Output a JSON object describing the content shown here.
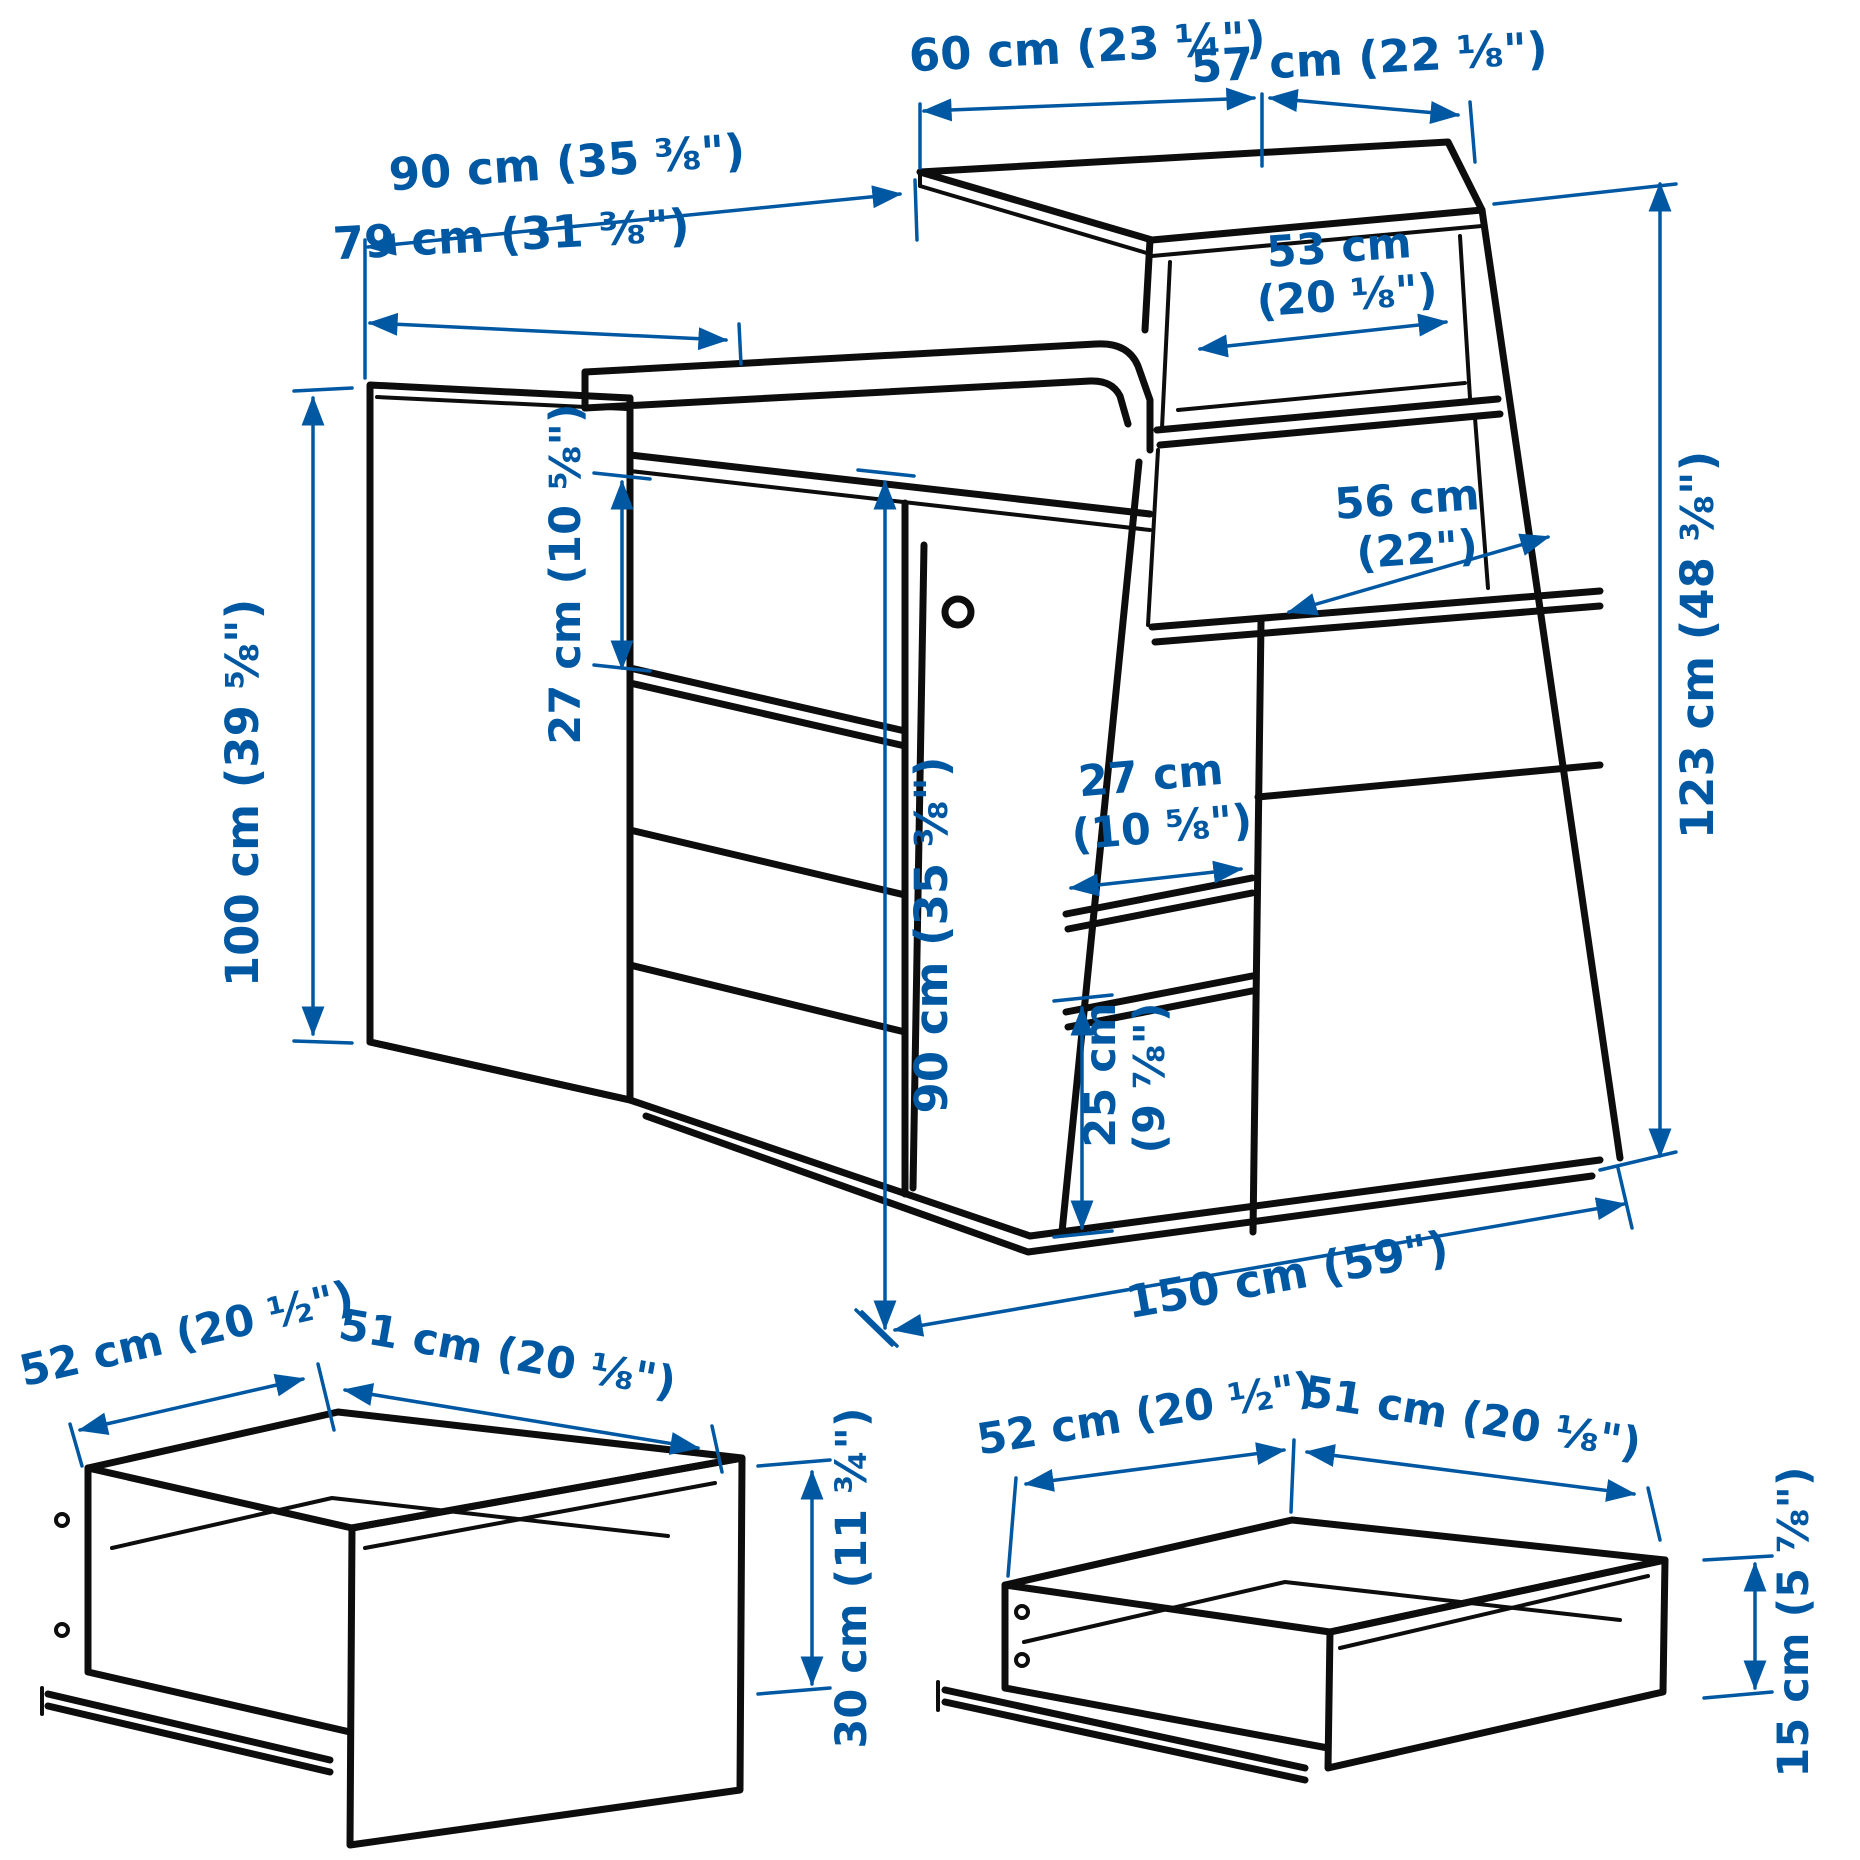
{
  "meta": {
    "description": "Furniture dimension diagram: changing table with storage and shelf unit, plus two drawer detail callouts",
    "colors": {
      "dimension_blue": "#0058A3",
      "line_black": "#0d0d0d",
      "background": "#ffffff"
    }
  },
  "main_diagram": {
    "top_left_width": "60 cm (23 ¼\")",
    "top_right_width": "57 cm (22 ⅛\")",
    "top_depth_total": "90 cm (35 ⅜\")",
    "table_depth": "79 cm (31 ⅜\")",
    "shelf_top_width_line1": "53 cm",
    "shelf_top_width_line2": "(20 ⅛\")",
    "shelf_mid_width_line1": "56 cm",
    "shelf_mid_width_line2": "(22\")",
    "left_opening_height": "27 cm (10 ⅝\")",
    "left_height": "100 cm (39 ⅝\")",
    "right_height": "123 cm (48 ⅜\")",
    "mid_opening_width_line1": "27 cm",
    "mid_opening_width_line2": "(10 ⅝\")",
    "front_height": "90 cm (35 ⅜\")",
    "bottom_opening_height_line1": "25 cm",
    "bottom_opening_height_line2": "(9 ⅞\")",
    "total_width": "150 cm (59\")"
  },
  "drawer_detail_left": {
    "width": "52 cm (20 ½\")",
    "depth": "51 cm (20 ⅛\")",
    "height": "30 cm (11 ¾\")"
  },
  "drawer_detail_right": {
    "width": "52 cm (20 ½\")",
    "depth": "51 cm (20 ⅛\")",
    "height": "15 cm (5 ⅞\")"
  }
}
